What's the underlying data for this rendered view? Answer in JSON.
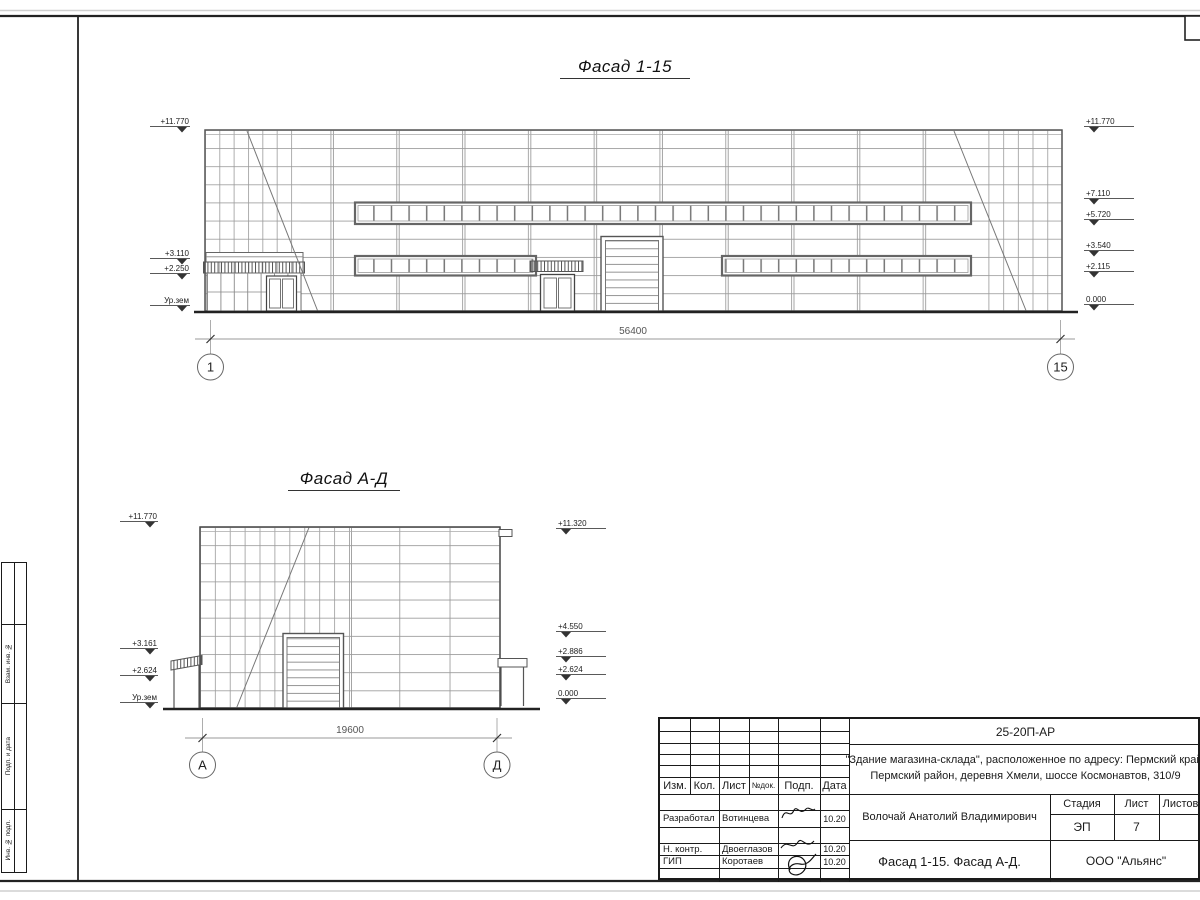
{
  "colors": {
    "frame": "#222222",
    "line": "#555555",
    "grid": "#9a9a9a"
  },
  "facade1": {
    "title": "Фасад 1-15",
    "dim": "56400",
    "axis_left": "1",
    "axis_right": "15",
    "marks_left": [
      "+11.770",
      "+3.110",
      "+2.250",
      "Ур.зем"
    ],
    "marks_right": [
      "+11.770",
      "+7.110",
      "+5.720",
      "+3.540",
      "+2.115",
      "0.000"
    ]
  },
  "facade2": {
    "title": "Фасад А-Д",
    "dim": "19600",
    "axis_left": "А",
    "axis_right": "Д",
    "marks_left": [
      "+11.770",
      "+3.161",
      "+2.624",
      "Ур.зем"
    ],
    "marks_right": [
      "+11.320",
      "+4.550",
      "+2.886",
      "+2.624",
      "0.000"
    ]
  },
  "side_stamp": {
    "labels": [
      "Взам. инв. №",
      "Подп. и дата",
      "Инв. № подл."
    ]
  },
  "title_block": {
    "doc_code": "25-20П-АР",
    "project_line1": "\"Здание магазина-склада\", расположенное по адресу: Пермский край,",
    "project_line2": "Пермский район, деревня Хмели, шоссе Космонавтов, 310/9",
    "header": {
      "izm": "Изм.",
      "kol": "Кол.",
      "list": "Лист",
      "ndok": "№док.",
      "podp": "Подп.",
      "data": "Дата"
    },
    "rows": [
      {
        "role": "Разработал",
        "name": "Вотинцева",
        "date": "10.20"
      },
      {
        "role": "Н. контр.",
        "name": "Двоеглазов",
        "date": "10.20"
      },
      {
        "role": "ГИП",
        "name": "Коротаев",
        "date": "10.20"
      }
    ],
    "chief": "Волочай Анатолий Владимирович",
    "stage_label": "Стадия",
    "sheet_label": "Лист",
    "sheets_label": "Листов",
    "stage": "ЭП",
    "sheet": "7",
    "sheets": "",
    "drawing_title": "Фасад 1-15. Фасад А-Д.",
    "company": "ООО \"Альянс\""
  }
}
